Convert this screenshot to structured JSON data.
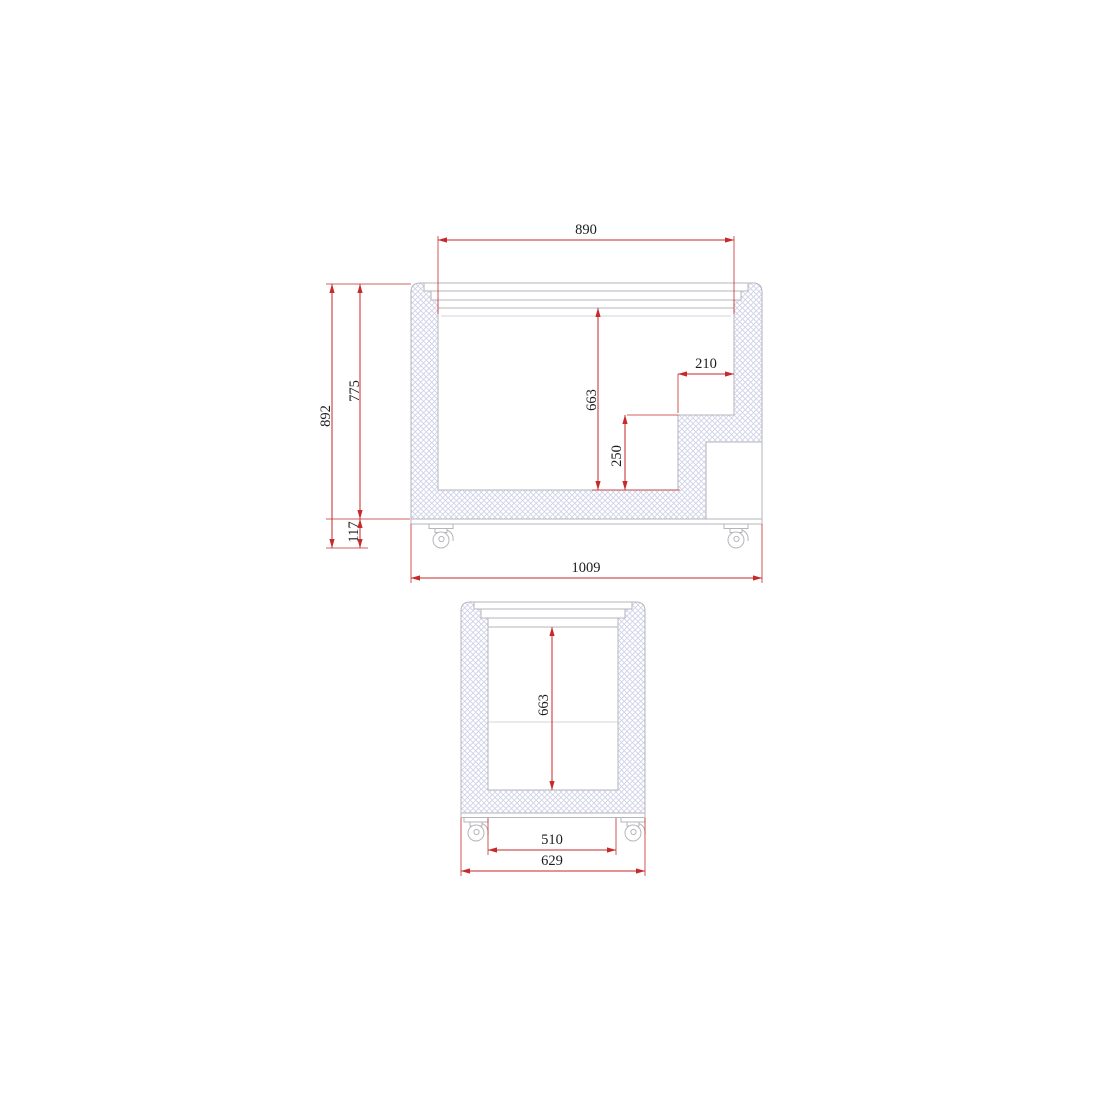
{
  "colors": {
    "dimension_red": "#c62a2a",
    "outline_gray": "#b5b6bc",
    "liner_gray": "#c6c7cc",
    "hatch_blue": "#cdd0e6",
    "text_black": "#1c1c1c",
    "background": "#ffffff"
  },
  "views": {
    "side_section": {
      "dims": {
        "opening_width": "890",
        "overall_height": "892",
        "body_height": "775",
        "base_height": "117",
        "inner_height": "663",
        "step_height": "250",
        "step_width": "210",
        "overall_length": "1009"
      }
    },
    "end_section": {
      "dims": {
        "inner_height": "663",
        "bottom_inner_width": "510",
        "overall_width": "629"
      }
    }
  }
}
